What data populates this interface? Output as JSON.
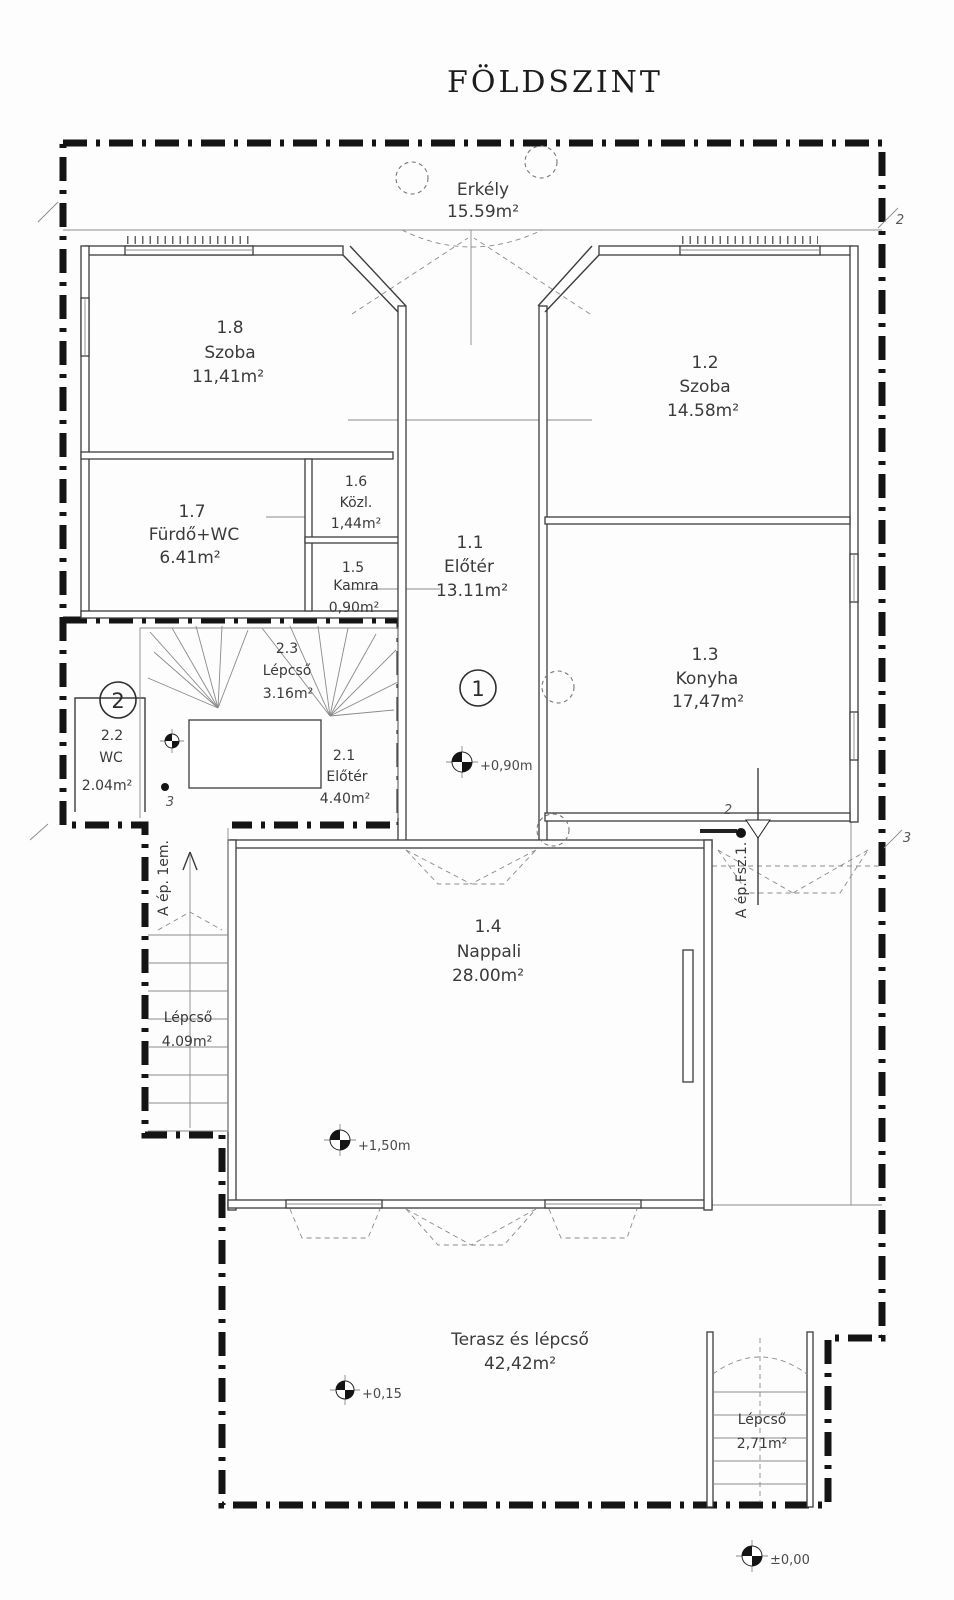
{
  "title": "FÖLDSZINT",
  "rooms": {
    "erkely": {
      "name": "Erkély",
      "area": "15.59m²"
    },
    "r18": {
      "number": "1.8",
      "name": "Szoba",
      "area": "11,41m²"
    },
    "r12": {
      "number": "1.2",
      "name": "Szoba",
      "area": "14.58m²"
    },
    "r17": {
      "number": "1.7",
      "name": "Fürdő+WC",
      "area": "6.41m²"
    },
    "r16": {
      "number": "1.6",
      "name": "Közl.",
      "area": "1,44m²"
    },
    "r15": {
      "number": "1.5",
      "name": "Kamra",
      "area": "0,90m²"
    },
    "r11": {
      "number": "1.1",
      "name": "Előtér",
      "area": "13.11m²"
    },
    "r13": {
      "number": "1.3",
      "name": "Konyha",
      "area": "17,47m²"
    },
    "r23": {
      "number": "2.3",
      "name": "Lépcső",
      "area": "3.16m²"
    },
    "r22": {
      "number": "2.2",
      "name": "WC",
      "area": "2.04m²"
    },
    "r21": {
      "number": "2.1",
      "name": "Előtér",
      "area": "4.40m²"
    },
    "lepcso_tower": {
      "name": "Lépcső",
      "area": "4.09m²"
    },
    "r14": {
      "number": "1.4",
      "name": "Nappali",
      "area": "28.00m²"
    },
    "terasz": {
      "name": "Terasz és lépcső",
      "area": "42,42m²"
    },
    "lepcso_br": {
      "name": "Lépcső",
      "area": "2,71m²"
    }
  },
  "levels": {
    "hall": "+0,90m",
    "nappali": "+1,50m",
    "terasz": "+0,15",
    "datum": "±0,00"
  },
  "annotations": {
    "stair_up_ref": "A ép. 1em.",
    "section_ref": "A ép.Fsz.1."
  },
  "axis": {
    "circle1": "1",
    "circle2": "2",
    "top_right": "2",
    "right_mid": "3",
    "section": "2",
    "stair_point": "3"
  },
  "colors": {
    "ink": "#2e2e2e",
    "boundary": "#141414",
    "paper": "#fdfdfd"
  }
}
